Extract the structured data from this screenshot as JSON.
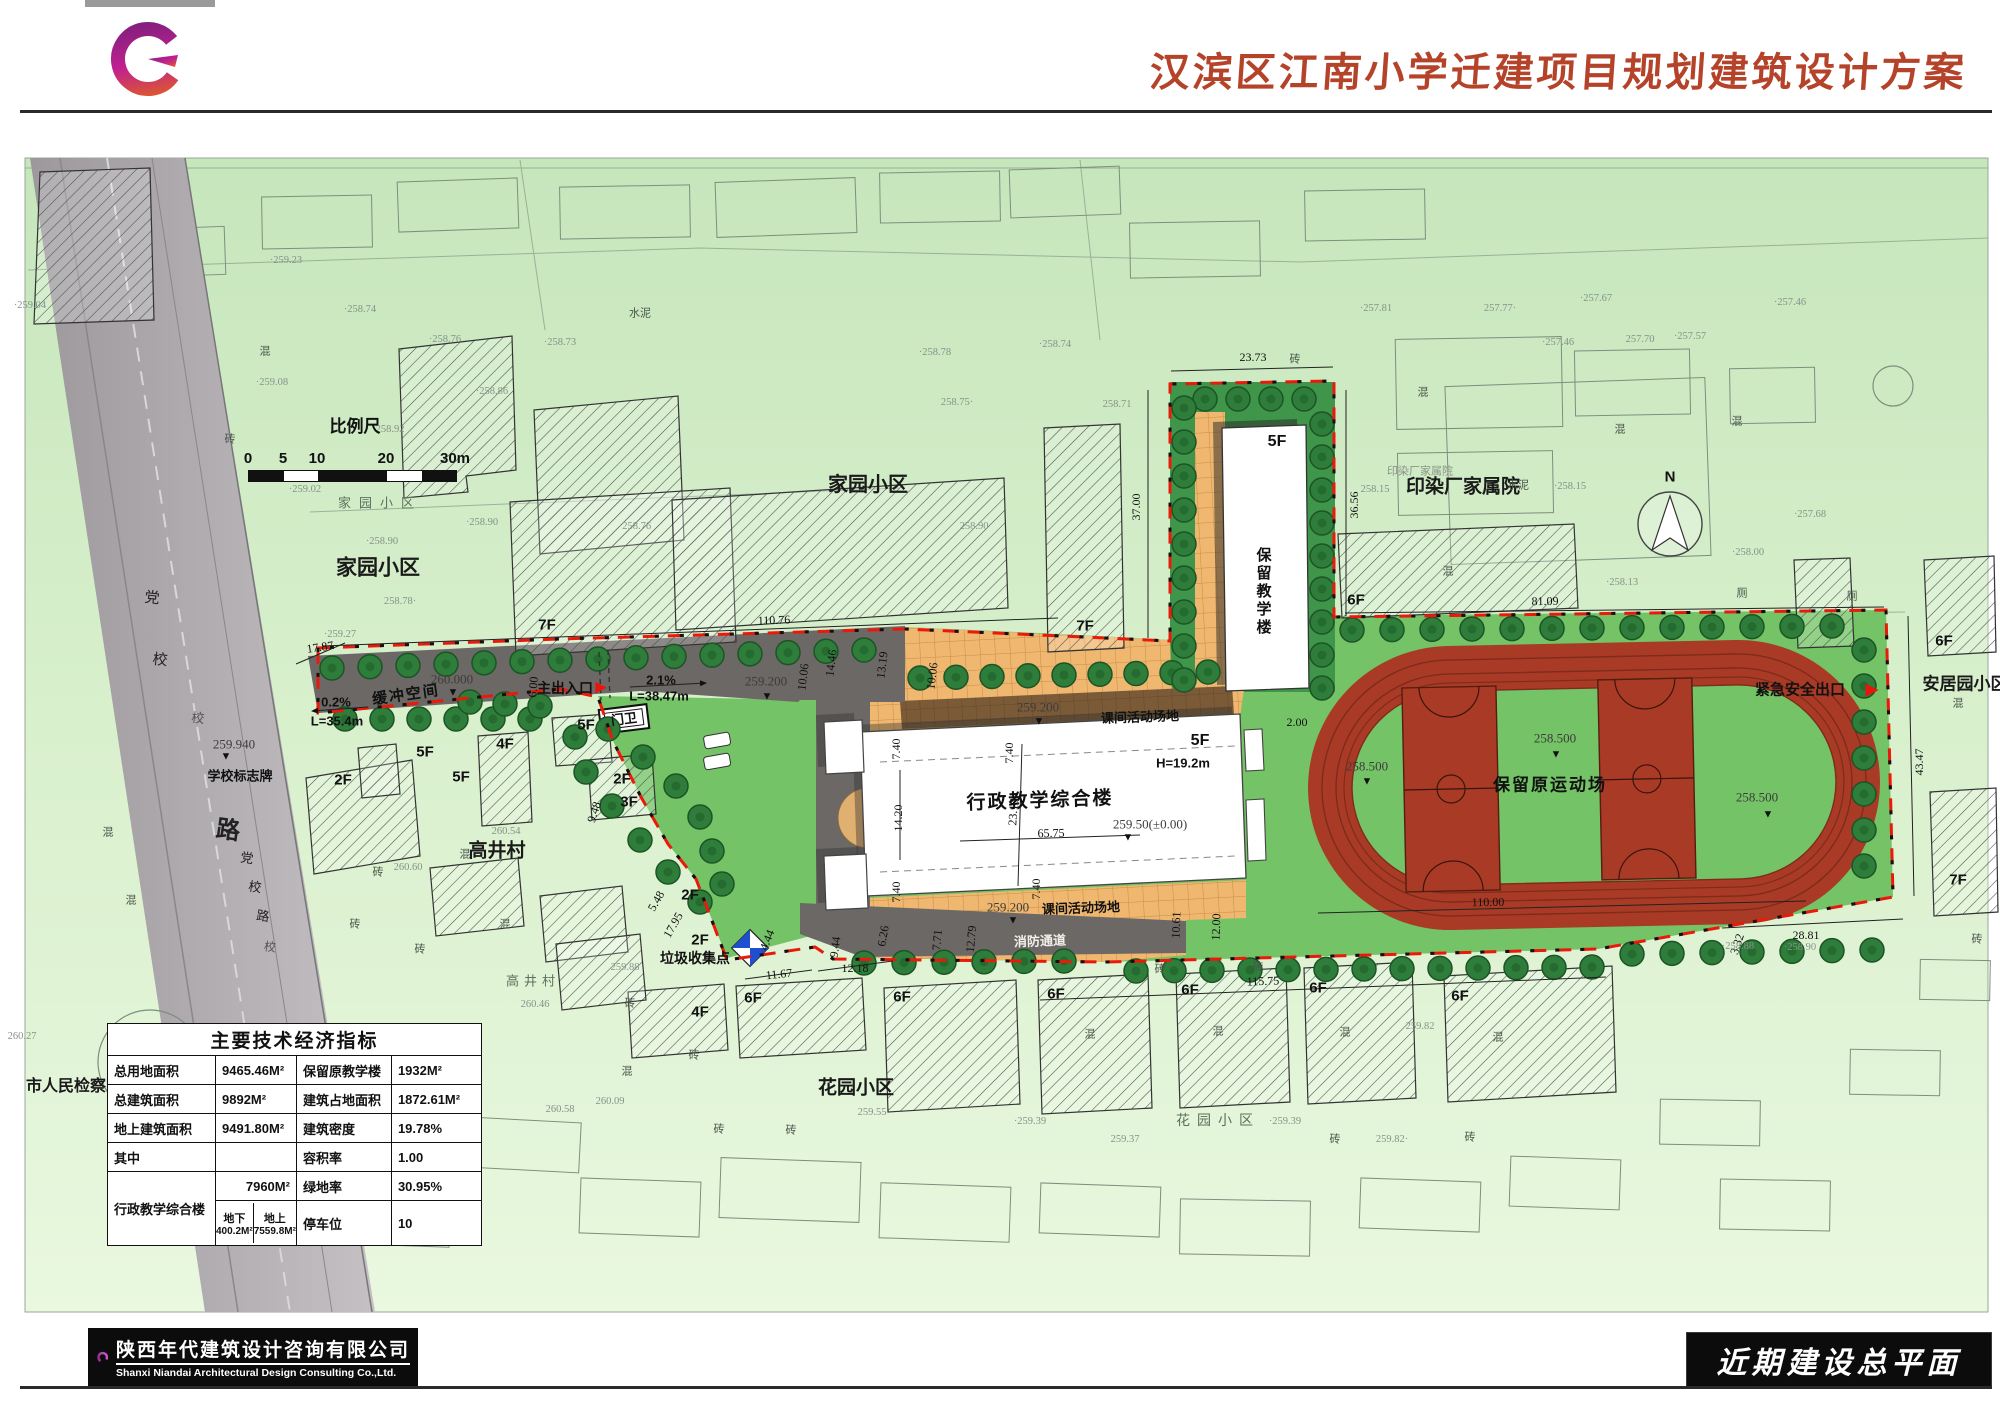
{
  "header": {
    "title": "汉滨区江南小学迁建项目规划建筑设计方案"
  },
  "footer": {
    "company_cn": "陕西年代建筑设计咨询有限公司",
    "company_en": "Shanxi Niandai Architectural Design Consulting Co.,Ltd.",
    "drawing_title": "近期建设总平面"
  },
  "scalebar": {
    "title": "比例尺",
    "ticks": [
      "0",
      "5",
      "10",
      "20",
      "30m"
    ]
  },
  "table": {
    "title": "主要技术经济指标",
    "rows": [
      [
        "总用地面积",
        "9465.46M²",
        "保留原教学楼",
        "1932M²"
      ],
      [
        "总建筑面积",
        "9892M²",
        "建筑占地面积",
        "1872.61M²"
      ],
      [
        "地上建筑面积",
        "9491.80M²",
        "建筑密度",
        "19.78%"
      ],
      [
        "其中",
        "",
        "容积率",
        "1.00"
      ]
    ],
    "merged_row_label": "行政教学综合楼",
    "r5_value": "7960M²",
    "r5_label": "绿地率",
    "r5_val2": "30.95%",
    "r6_below_label": "地下",
    "r6_below_value": "400.2M²",
    "r6_above_label": "地上",
    "r6_above_value": "7559.8M²",
    "r6_label": "停车位",
    "r6_value": "10"
  },
  "plan": {
    "area_labels": [
      {
        "t": "家园小区",
        "x": 380,
        "y": 503,
        "s": 13,
        "b": 0,
        "c": "#5d6f5d",
        "ls": 8
      },
      {
        "t": "家园小区",
        "x": 378,
        "y": 568,
        "s": 21
      },
      {
        "t": "家园小区",
        "x": 868,
        "y": 485,
        "s": 20
      },
      {
        "t": "高井村",
        "x": 497,
        "y": 851,
        "s": 19
      },
      {
        "t": "高井村",
        "x": 533,
        "y": 981,
        "s": 13,
        "b": 0,
        "c": "#5d6f5d",
        "ls": 5
      },
      {
        "t": "花园小区",
        "x": 856,
        "y": 1088,
        "s": 19
      },
      {
        "t": "花园小区",
        "x": 1218,
        "y": 1120,
        "s": 14,
        "b": 0,
        "c": "#5d6f5d",
        "ls": 7
      },
      {
        "t": "印染厂家属院",
        "x": 1463,
        "y": 487,
        "s": 19
      },
      {
        "t": "印染厂家属院",
        "x": 1420,
        "y": 472,
        "s": 11,
        "b": 0,
        "c": "#8a958a"
      },
      {
        "t": "安居园小区",
        "x": 1965,
        "y": 684,
        "s": 17
      },
      {
        "t": "市人民检察院",
        "x": 74,
        "y": 1087,
        "s": 16
      }
    ],
    "road_labels": [
      {
        "t": "党",
        "x": 152,
        "y": 599,
        "s": 15,
        "r": 6
      },
      {
        "t": "校",
        "x": 160,
        "y": 661,
        "s": 15,
        "r": 6
      },
      {
        "t": "校",
        "x": 198,
        "y": 718,
        "s": 13,
        "c": "#555",
        "r": 6
      },
      {
        "t": "路",
        "x": 228,
        "y": 831,
        "s": 24,
        "b": 1,
        "r": 8
      },
      {
        "t": "党",
        "x": 247,
        "y": 858,
        "s": 13,
        "r": 8
      },
      {
        "t": "校",
        "x": 255,
        "y": 887,
        "s": 13,
        "r": 8
      },
      {
        "t": "路",
        "x": 263,
        "y": 916,
        "s": 13,
        "r": 8
      },
      {
        "t": "校",
        "x": 270,
        "y": 947,
        "s": 12,
        "c": "#555",
        "r": 8
      }
    ],
    "floor_labels": [
      {
        "t": "5F",
        "x": 1277,
        "y": 442,
        "s": 16
      },
      {
        "t": "5F",
        "x": 1200,
        "y": 741,
        "s": 16
      },
      {
        "t": "7F",
        "x": 547,
        "y": 625
      },
      {
        "t": "7F",
        "x": 1085,
        "y": 626
      },
      {
        "t": "5F",
        "x": 586,
        "y": 725
      },
      {
        "t": "5F",
        "x": 425,
        "y": 752
      },
      {
        "t": "5F",
        "x": 461,
        "y": 777
      },
      {
        "t": "4F",
        "x": 505,
        "y": 744
      },
      {
        "t": "2F",
        "x": 343,
        "y": 780
      },
      {
        "t": "2F",
        "x": 622,
        "y": 779
      },
      {
        "t": "3F",
        "x": 629,
        "y": 802
      },
      {
        "t": "2F",
        "x": 690,
        "y": 895
      },
      {
        "t": "2F",
        "x": 700,
        "y": 940
      },
      {
        "t": "4F",
        "x": 700,
        "y": 1012
      },
      {
        "t": "6F",
        "x": 753,
        "y": 998
      },
      {
        "t": "6F",
        "x": 902,
        "y": 997
      },
      {
        "t": "6F",
        "x": 1056,
        "y": 994
      },
      {
        "t": "6F",
        "x": 1190,
        "y": 990
      },
      {
        "t": "6F",
        "x": 1318,
        "y": 988
      },
      {
        "t": "6F",
        "x": 1460,
        "y": 996
      },
      {
        "t": "6F",
        "x": 1356,
        "y": 600
      },
      {
        "t": "6F",
        "x": 1944,
        "y": 641
      },
      {
        "t": "7F",
        "x": 1958,
        "y": 880
      }
    ],
    "feature_labels": [
      {
        "t": "缓冲空间",
        "x": 406,
        "y": 695,
        "s": 15,
        "r": -8,
        "ls": 2
      },
      {
        "t": "主出入口",
        "x": 565,
        "y": 688,
        "s": 14
      },
      {
        "t": "门卫",
        "x": 624,
        "y": 719,
        "s": 13,
        "r": -7
      },
      {
        "t": "学校标志牌",
        "x": 240,
        "y": 776,
        "s": 13
      },
      {
        "t": "垃圾收集点",
        "x": 695,
        "y": 958,
        "s": 14
      },
      {
        "t": "紧急安全出口",
        "x": 1800,
        "y": 690,
        "s": 15
      },
      {
        "t": "保留原运动场",
        "x": 1550,
        "y": 785,
        "s": 17,
        "ls": 2
      },
      {
        "t": "行政教学综合楼",
        "x": 1040,
        "y": 801,
        "s": 19,
        "ls": 2,
        "r": -2
      },
      {
        "t": "保留教学楼",
        "x": 1263,
        "y": 592,
        "s": 15,
        "v": 1,
        "ls": 3
      },
      {
        "t": "H=19.2m",
        "x": 1183,
        "y": 763,
        "s": 13
      },
      {
        "t": "课间活动场地",
        "x": 1140,
        "y": 717,
        "s": 13,
        "r": -2
      },
      {
        "t": "课间活动场地",
        "x": 1081,
        "y": 908,
        "s": 13,
        "r": -2
      },
      {
        "t": "消防通道",
        "x": 1040,
        "y": 941,
        "s": 13,
        "c": "#f0efe8",
        "r": -2
      },
      {
        "t": "N",
        "x": 1670,
        "y": 477,
        "s": 15
      }
    ],
    "elevation_texts": [
      {
        "t": "259.940",
        "x": 234,
        "y": 744
      },
      {
        "t": "260.000",
        "x": 452,
        "y": 679
      },
      {
        "t": "259.200",
        "x": 766,
        "y": 681
      },
      {
        "t": "259.200",
        "x": 1038,
        "y": 707
      },
      {
        "t": "259.200",
        "x": 1008,
        "y": 907
      },
      {
        "t": "258.500",
        "x": 1367,
        "y": 766
      },
      {
        "t": "258.500",
        "x": 1555,
        "y": 738
      },
      {
        "t": "258.500",
        "x": 1757,
        "y": 797
      },
      {
        "t": "259.50(±0.00)",
        "x": 1150,
        "y": 824
      }
    ],
    "markers": [
      {
        "t": "▼",
        "x": 226,
        "y": 757,
        "s": 11
      },
      {
        "t": "▼",
        "x": 453,
        "y": 693,
        "s": 11
      },
      {
        "t": "▼",
        "x": 767,
        "y": 697,
        "s": 11
      },
      {
        "t": "▼",
        "x": 1039,
        "y": 722,
        "s": 11
      },
      {
        "t": "▼",
        "x": 1013,
        "y": 921,
        "s": 11
      },
      {
        "t": "▼",
        "x": 1367,
        "y": 782,
        "s": 11
      },
      {
        "t": "▼",
        "x": 1556,
        "y": 755,
        "s": 11
      },
      {
        "t": "▼",
        "x": 1768,
        "y": 815,
        "s": 11
      },
      {
        "t": "▼",
        "x": 1128,
        "y": 838,
        "s": 11
      },
      {
        "t": "▶",
        "x": 601,
        "y": 687,
        "s": 15,
        "c": "#e8150d"
      },
      {
        "t": "▶",
        "x": 1872,
        "y": 689,
        "s": 17,
        "c": "#e8150d"
      }
    ],
    "dimensions": [
      {
        "t": "17.87",
        "x": 320,
        "y": 647,
        "r": -8
      },
      {
        "t": "110.76",
        "x": 774,
        "y": 620,
        "r": -2
      },
      {
        "t": "23.73",
        "x": 1253,
        "y": 357
      },
      {
        "t": "37.00",
        "x": 1136,
        "y": 507,
        "r": -90
      },
      {
        "t": "36.56",
        "x": 1354,
        "y": 505,
        "r": -90
      },
      {
        "t": "81.09",
        "x": 1545,
        "y": 601,
        "r": -1
      },
      {
        "t": "43.47",
        "x": 1919,
        "y": 762,
        "r": -90
      },
      {
        "t": "28.81",
        "x": 1806,
        "y": 935
      },
      {
        "t": "3.32",
        "x": 1737,
        "y": 944,
        "r": -72
      },
      {
        "t": "110.00",
        "x": 1488,
        "y": 902,
        "r": -1
      },
      {
        "t": "115.75",
        "x": 1263,
        "y": 981,
        "r": -2
      },
      {
        "t": "12.18",
        "x": 855,
        "y": 968
      },
      {
        "t": "11.67",
        "x": 779,
        "y": 974,
        "r": -6
      },
      {
        "t": "9.44",
        "x": 835,
        "y": 947,
        "r": -82
      },
      {
        "t": "4.44",
        "x": 767,
        "y": 940,
        "r": -68
      },
      {
        "t": "6.26",
        "x": 883,
        "y": 936,
        "r": -80
      },
      {
        "t": "7.71",
        "x": 937,
        "y": 940,
        "r": -85
      },
      {
        "t": "12.79",
        "x": 971,
        "y": 939,
        "r": -85
      },
      {
        "t": "7.40",
        "x": 896,
        "y": 749,
        "r": -90
      },
      {
        "t": "7.40",
        "x": 896,
        "y": 892,
        "r": -90
      },
      {
        "t": "7.40",
        "x": 1009,
        "y": 753,
        "r": -90
      },
      {
        "t": "7.40",
        "x": 1036,
        "y": 889,
        "r": -90
      },
      {
        "t": "14.20",
        "x": 898,
        "y": 818,
        "r": -90
      },
      {
        "t": "23.10",
        "x": 1013,
        "y": 812,
        "r": -87
      },
      {
        "t": "65.75",
        "x": 1051,
        "y": 833,
        "r": -1
      },
      {
        "t": "2.00",
        "x": 1297,
        "y": 722
      },
      {
        "t": "6.00",
        "x": 533,
        "y": 687,
        "r": -85
      },
      {
        "t": "9.48",
        "x": 594,
        "y": 812,
        "r": -72
      },
      {
        "t": "5.48",
        "x": 656,
        "y": 901,
        "r": -60
      },
      {
        "t": "17.95",
        "x": 673,
        "y": 925,
        "r": -60
      },
      {
        "t": "10.06",
        "x": 803,
        "y": 677,
        "r": -83
      },
      {
        "t": "14.46",
        "x": 831,
        "y": 663,
        "r": -83
      },
      {
        "t": "13.19",
        "x": 882,
        "y": 665,
        "r": -83
      },
      {
        "t": "10.06",
        "x": 932,
        "y": 676,
        "r": -83
      },
      {
        "t": "10.61",
        "x": 1176,
        "y": 925,
        "r": -88
      },
      {
        "t": "12.00",
        "x": 1216,
        "y": 927,
        "r": -88
      }
    ],
    "slope_labels": [
      {
        "t": "0.2%",
        "x": 336,
        "y": 702
      },
      {
        "t": "L=35.4m",
        "x": 337,
        "y": 721
      },
      {
        "t": "2.1%",
        "x": 661,
        "y": 680
      },
      {
        "t": "L=38.47m",
        "x": 659,
        "y": 696
      }
    ],
    "material_labels": [
      {
        "t": "混",
        "x": 265,
        "y": 352
      },
      {
        "t": "水泥",
        "x": 640,
        "y": 314
      },
      {
        "t": "砖",
        "x": 230,
        "y": 440
      },
      {
        "t": "混",
        "x": 108,
        "y": 833
      },
      {
        "t": "混",
        "x": 131,
        "y": 901
      },
      {
        "t": "砖",
        "x": 355,
        "y": 925
      },
      {
        "t": "混",
        "x": 465,
        "y": 855
      },
      {
        "t": "砖",
        "x": 378,
        "y": 873
      },
      {
        "t": "砖",
        "x": 420,
        "y": 950
      },
      {
        "t": "混",
        "x": 505,
        "y": 925
      },
      {
        "t": "砖",
        "x": 1295,
        "y": 360
      },
      {
        "t": "混",
        "x": 1423,
        "y": 393
      },
      {
        "t": "混",
        "x": 1620,
        "y": 430
      },
      {
        "t": "混",
        "x": 1737,
        "y": 422
      },
      {
        "t": "水泥",
        "x": 1518,
        "y": 486
      },
      {
        "t": "混",
        "x": 1448,
        "y": 572
      },
      {
        "t": "厕",
        "x": 1742,
        "y": 594
      },
      {
        "t": "厕",
        "x": 1852,
        "y": 597
      },
      {
        "t": "混",
        "x": 1958,
        "y": 704
      },
      {
        "t": "砖",
        "x": 1977,
        "y": 940
      },
      {
        "t": "砖",
        "x": 630,
        "y": 1004
      },
      {
        "t": "混",
        "x": 627,
        "y": 1072
      },
      {
        "t": "砖",
        "x": 694,
        "y": 1056
      },
      {
        "t": "砖",
        "x": 719,
        "y": 1130
      },
      {
        "t": "砖",
        "x": 791,
        "y": 1131
      },
      {
        "t": "砖",
        "x": 1160,
        "y": 970
      },
      {
        "t": "砖",
        "x": 1258,
        "y": 968
      },
      {
        "t": "混",
        "x": 1090,
        "y": 1035
      },
      {
        "t": "混",
        "x": 1218,
        "y": 1032
      },
      {
        "t": "混",
        "x": 1345,
        "y": 1033
      },
      {
        "t": "混",
        "x": 1498,
        "y": 1038
      },
      {
        "t": "砖",
        "x": 1335,
        "y": 1140
      },
      {
        "t": "砖",
        "x": 1470,
        "y": 1138
      }
    ],
    "spot_elevations": [
      {
        "t": "·258.74",
        "x": 360,
        "y": 310
      },
      {
        "t": "·258.76",
        "x": 445,
        "y": 340
      },
      {
        "t": "·258.73",
        "x": 560,
        "y": 343
      },
      {
        "t": "·259.08",
        "x": 272,
        "y": 383
      },
      {
        "t": "·258.86",
        "x": 492,
        "y": 392
      },
      {
        "t": "258.92",
        "x": 390,
        "y": 430
      },
      {
        "t": "·259.02",
        "x": 305,
        "y": 490
      },
      {
        "t": "·258.90",
        "x": 482,
        "y": 523
      },
      {
        "t": "·258.90",
        "x": 382,
        "y": 542
      },
      {
        "t": "·258.76",
        "x": 635,
        "y": 527
      },
      {
        "t": "258.78·",
        "x": 400,
        "y": 602
      },
      {
        "t": "·259.27",
        "x": 340,
        "y": 635
      },
      {
        "t": "·258.78",
        "x": 935,
        "y": 353
      },
      {
        "t": "·258.74",
        "x": 1055,
        "y": 345
      },
      {
        "t": "258.75·",
        "x": 957,
        "y": 403
      },
      {
        "t": "258.71",
        "x": 1117,
        "y": 405
      },
      {
        "t": "258.90",
        "x": 974,
        "y": 527
      },
      {
        "t": "·257.81",
        "x": 1376,
        "y": 309
      },
      {
        "t": "257.77·",
        "x": 1500,
        "y": 309
      },
      {
        "t": "·257.67",
        "x": 1596,
        "y": 299
      },
      {
        "t": "·257.46",
        "x": 1558,
        "y": 343
      },
      {
        "t": "257.70",
        "x": 1640,
        "y": 340
      },
      {
        "t": "·257.57",
        "x": 1690,
        "y": 337
      },
      {
        "t": "·257.46",
        "x": 1790,
        "y": 303
      },
      {
        "t": "258.15",
        "x": 1375,
        "y": 490
      },
      {
        "t": "·258.15",
        "x": 1570,
        "y": 487
      },
      {
        "t": "·257.68",
        "x": 1810,
        "y": 515
      },
      {
        "t": "·258.00",
        "x": 1748,
        "y": 553
      },
      {
        "t": "·258.13",
        "x": 1622,
        "y": 583
      },
      {
        "t": "·259.39",
        "x": 1030,
        "y": 1122
      },
      {
        "t": "259.37",
        "x": 1125,
        "y": 1140
      },
      {
        "t": "·259.39",
        "x": 1285,
        "y": 1122
      },
      {
        "t": "259.82",
        "x": 1420,
        "y": 1027
      },
      {
        "t": "259.82·",
        "x": 1392,
        "y": 1140
      },
      {
        "t": "260.46",
        "x": 535,
        "y": 1005
      },
      {
        "t": "259.88",
        "x": 625,
        "y": 968
      },
      {
        "t": "260.09",
        "x": 610,
        "y": 1102
      },
      {
        "t": "259.55",
        "x": 872,
        "y": 1113
      },
      {
        "t": "260.58",
        "x": 560,
        "y": 1110
      },
      {
        "t": "260.27",
        "x": 22,
        "y": 1037
      },
      {
        "t": "·259.23",
        "x": 286,
        "y": 261
      },
      {
        "t": "·259.04",
        "x": 30,
        "y": 306
      },
      {
        "t": "·258.88",
        "x": 1738,
        "y": 947
      },
      {
        "t": "·258.90",
        "x": 1800,
        "y": 948
      },
      {
        "t": "260.54",
        "x": 506,
        "y": 832
      },
      {
        "t": "260.60",
        "x": 408,
        "y": 868
      }
    ]
  }
}
